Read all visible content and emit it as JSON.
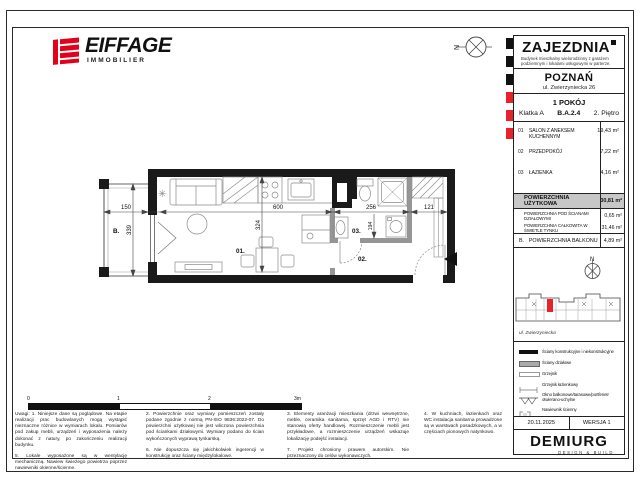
{
  "header": {
    "brand": "EIFFAGE",
    "brand_sub": "IMMOBILIER"
  },
  "title_block": {
    "project": "ZAJEZDNIA",
    "project_subtitle": "Budynek mieszkalny wielorodzinny z garażem podziemnym i lokalami usługowymi w parterze.",
    "city": "POZNAŃ",
    "address": "ul. Zwierzyniecka 26",
    "unit_type": "1 POKÓJ",
    "staircase": "Klatka A",
    "unit_id": "B.A.2.4",
    "floor": "2. Piętro",
    "rooms": [
      {
        "no": "01",
        "name": "SALON Z ANEKSEM KUCHENNYM",
        "area": "19,43 m²"
      },
      {
        "no": "02",
        "name": "PRZEDPOKÓJ",
        "area": "7,22 m²"
      },
      {
        "no": "03",
        "name": "ŁAZIENKA",
        "area": "4,16 m²"
      }
    ],
    "usable_area_label": "POWIERZCHNIA UŻYTKOWA",
    "usable_area_value": "30,81 m²",
    "sub_areas": [
      {
        "label": "POWIERZCHNIA POD ŚCIANAMI DZIAŁOWYMI",
        "value": "0,65 m²"
      },
      {
        "label": "POWIERZCHNIA CAŁKOWITA W ŚWIETLE TYNKU",
        "value": "31,46 m²"
      }
    ],
    "balcony_row": {
      "no": "B.",
      "label": "POWIERZCHNIA BALKONU",
      "value": "4,89 m²"
    },
    "compass_n": "N",
    "street_label": "ul. Zwierzyniecka",
    "legend": [
      "Ściany konstrukcyjne i niekonstrukcyjne",
      "Ściany działowe",
      "Grzejnik",
      "Grzejnik łazienkowy",
      "Okno balkonowe/tarasowe/portfenetr otwierano-uchylne",
      "Nawiewnik ścienny"
    ],
    "date": "20.11.2025",
    "version": "WERSJA 1",
    "company": "DEMIURG",
    "company_sub": "DESIGN & BUILD"
  },
  "plan": {
    "compass_n": "N",
    "labels": {
      "balcony": "B.",
      "living": "01.",
      "hall": "02.",
      "bath": "03."
    },
    "dims": {
      "w_balcony": "150",
      "w_room": "600",
      "w_bath": "256",
      "w_hall": "121",
      "h_balcony": "339",
      "h_room": "324",
      "h_bath": "194"
    }
  },
  "scalebar": {
    "t0": "0",
    "t1": "1",
    "t2": "2",
    "t3": "3m"
  },
  "notes": [
    "Uwagi: 1. Niniejsze dane są poglądowe. Na etapie realizacji prac budowlanych mogą wystąpić nieznaczne różnice w wymiarach lokalu. Pomiarów pod zakup mebli, urządzeń i wyposażenia należy dokonać z natury, po zakończeniu realizacji budynku.",
    "2. Powierzchnie oraz wymiary pomieszczeń zostały podane zgodnie z normą PN-ISO 9836:2022-07. Do powierzchni użytkowej nie jest wliczona powierzchnia pod ściankami działowymi. Wymiary podano do ścian wykończonych wyprawą tynkarską.",
    "3. Elementy aranżacji mieszkania (drzwi wewnętrzne, meble, ceramika sanitarna, sprzęt AGD i RTV) nie stanowią oferty handlowej. Rozmieszczenie mebli jest przykładowe, a rozmieszczenie urządzeń wskazuje lokalizację podejść instalacji.",
    "4. W kuchniach, łazienkach oraz WC instalacja sanitarna prowadzone są w warstwach posadzkowych, a w częściach pionowych natynkowo.",
    "5. Lokale wyposażone są w wentylację mechaniczną. Nawiew świeżego powietrza poprzez nawiewniki okienne/ścienne.",
    "6. Nie dopuszcza się jakichkolwiek ingerencji w konstrukcję oraz ściany międzylokalowe.",
    "7. Projekt chroniony prawem autorskim. Nie przeznaczony do celów wykonawczych."
  ]
}
